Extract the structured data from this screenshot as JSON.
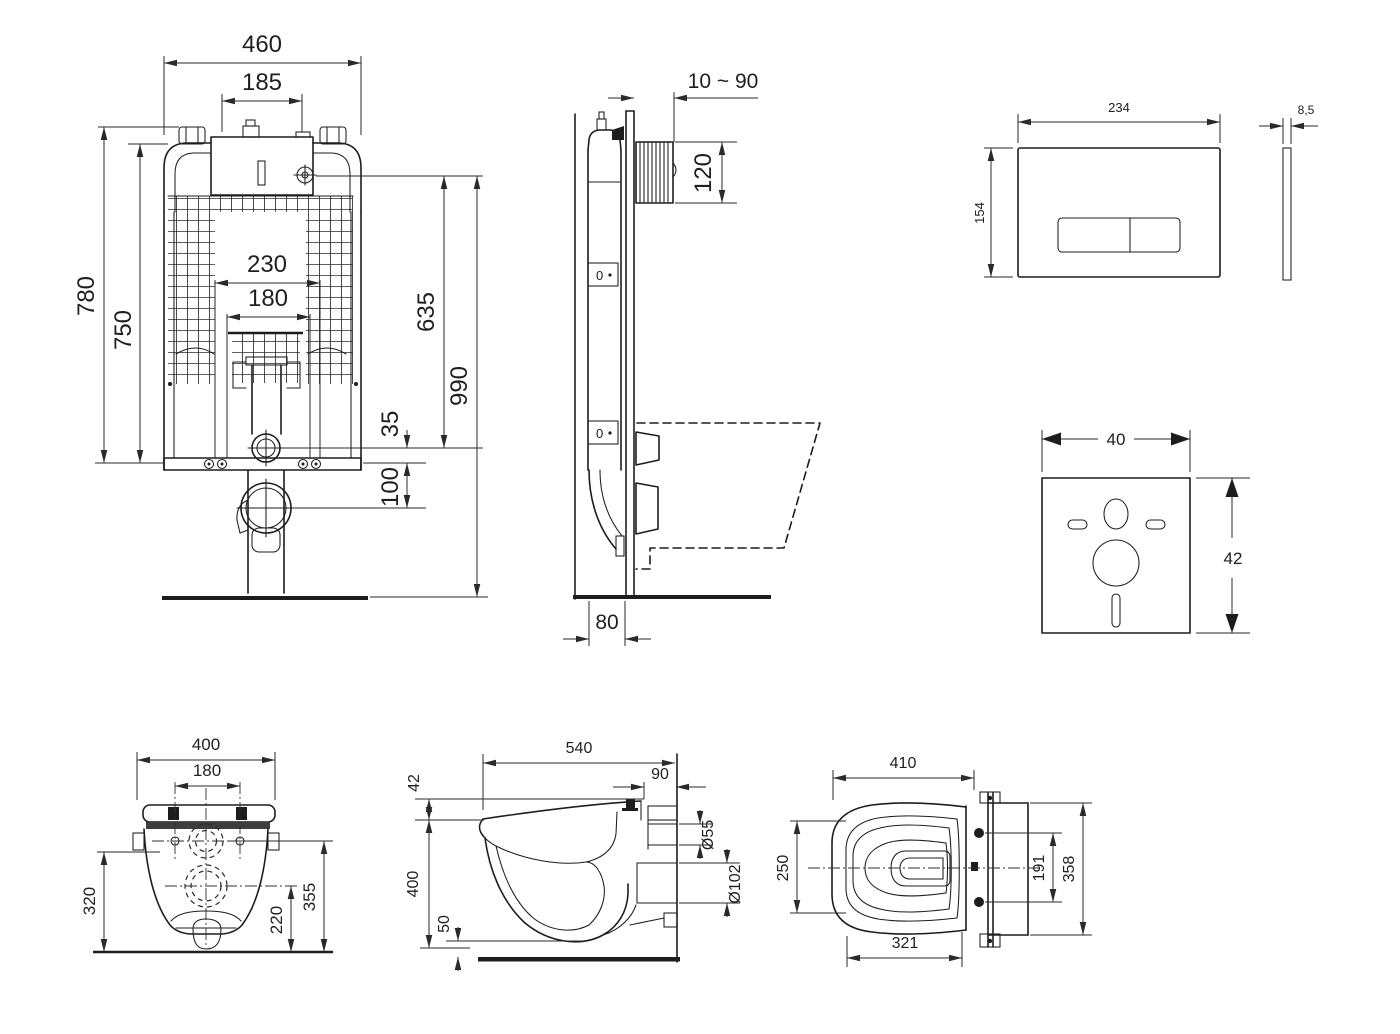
{
  "colors": {
    "background": "#ffffff",
    "line": "#1d1d1d",
    "dim_text": "#1f1f1f"
  },
  "views": {
    "cistern_front": {
      "dims": {
        "total_width": "460",
        "top_opening": "185",
        "frame_height": "780",
        "tank_height": "750",
        "duct_width": "230",
        "duct_inner": "180",
        "valve_height": "635",
        "overall_height": "990",
        "drain_offset": "35",
        "outlet_offset": "100"
      }
    },
    "cistern_side": {
      "dims": {
        "wall_distance": "10 ~ 90",
        "access_depth": "120",
        "frame_depth": "80"
      },
      "level_indicator": "0"
    },
    "flush_plate": {
      "dims": {
        "width": "234",
        "height": "154",
        "thickness": "8,5"
      }
    },
    "sound_mat": {
      "dims": {
        "width": "40",
        "height": "42"
      }
    },
    "bowl_rear": {
      "dims": {
        "width": "400",
        "hole_spacing": "180",
        "height_left": "320",
        "height_right": "355",
        "outlet_height": "220"
      }
    },
    "bowl_side": {
      "dims": {
        "depth": "540",
        "rim_thickness": "42",
        "rear_depth": "90",
        "inlet_diameter": "Ø55",
        "outlet_diameter": "Ø102",
        "height": "400",
        "clearance": "50"
      }
    },
    "bowl_top": {
      "dims": {
        "width": "410",
        "bowl_width": "250",
        "hole_spacing": "191",
        "depth": "358",
        "seat_depth": "321"
      }
    }
  }
}
